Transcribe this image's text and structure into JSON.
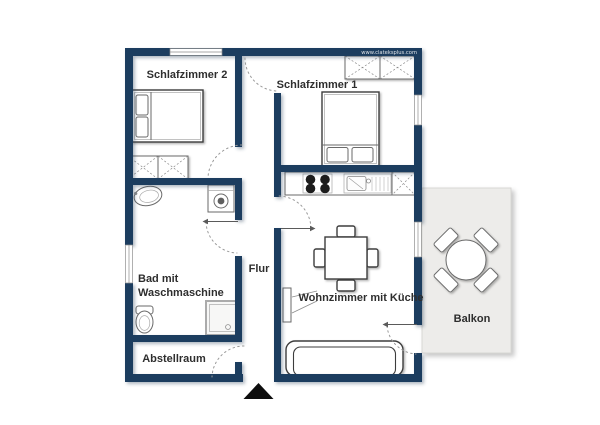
{
  "watermark": {
    "text": "www.clateksplus.com"
  },
  "colors": {
    "wall": "#1d3c5f",
    "door_arc": "#999999",
    "furniture_line": "#6a6a6a",
    "furniture_dark": "#3e3e3e",
    "label_text": "#2e2e2e",
    "balcony_fill": "#edecea",
    "balcony_edge": "#d8d7d4",
    "burner": "#1c1c1c",
    "entrance_arrow": "#0d0d0d"
  },
  "rooms": {
    "schlafzimmer2": {
      "label": "Schlafzimmer 2"
    },
    "schlafzimmer1": {
      "label": "Schlafzimmer 1"
    },
    "bad": {
      "label_line1": "Bad mit",
      "label_line2": "Waschmaschine"
    },
    "flur": {
      "label": "Flur"
    },
    "abstellraum": {
      "label": "Abstellraum"
    },
    "wohnzimmer": {
      "label": "Wohnzimmer mit Küche"
    },
    "balkon": {
      "label": "Balkon"
    }
  }
}
